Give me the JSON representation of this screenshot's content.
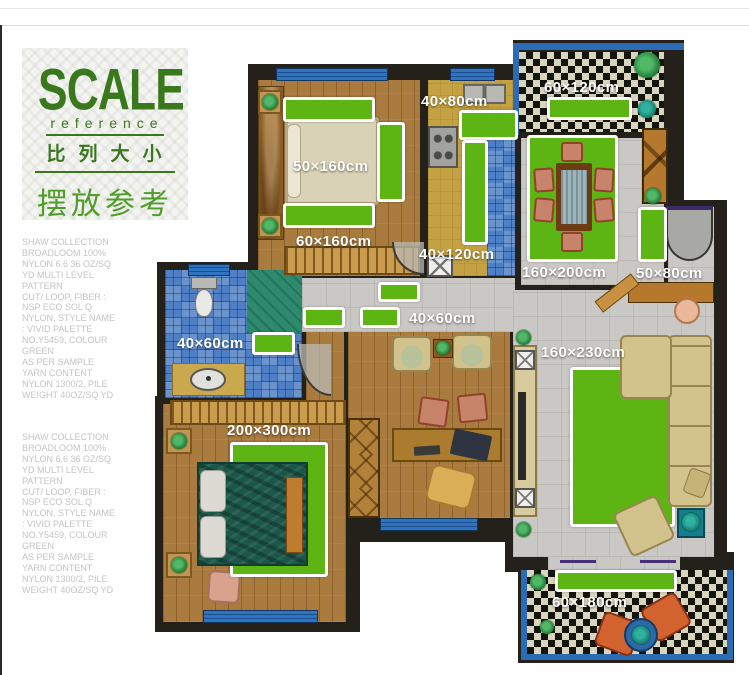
{
  "title_block": {
    "headline": "SCALE",
    "subline": "reference",
    "cn_line1": "比列大小",
    "cn_line2": "摆放参考"
  },
  "spec_text": {
    "block": "SHAW COLLECTION\nBROADLOOM 100%\nNYLON 6.6 36 OZ/SQ\nYD MULTI LEVEL\nPATTERN\nCUT/ LOOP, FIBER :\nNSP ECO SOL Q\nNYLON, STYLE NAME\n: VIVID PALETTE\nNO.Y5459, COLOUR\nGREEN\nAS PER SAMPLE\nYARN CONTENT\nNYLON 1300/2, PILE\nWEIGHT 40OZ/SQ YD"
  },
  "markers": [
    {
      "label": "50×160cm"
    },
    {
      "label": "60×160cm"
    },
    {
      "label": "40×80cm"
    },
    {
      "label": "40×120cm"
    },
    {
      "label": "60×120cm"
    },
    {
      "label": "160×200cm"
    },
    {
      "label": "50×80cm"
    },
    {
      "label": "40×60cm"
    },
    {
      "label": "40×60cm"
    },
    {
      "label": "160×230cm"
    },
    {
      "label": "200×300cm"
    },
    {
      "label": "60×180cm"
    }
  ],
  "colors": {
    "marker_green": "#5cb512",
    "title_green": "#39781c",
    "title_green_light": "#4f9e2a",
    "wall_dark": "#232119",
    "wood_floor": "#a97b3e",
    "blue_tile": "#4f7fc4",
    "gray_tile": "#c9c8c4",
    "balcony_frame_blue": "#2b6cb4"
  }
}
